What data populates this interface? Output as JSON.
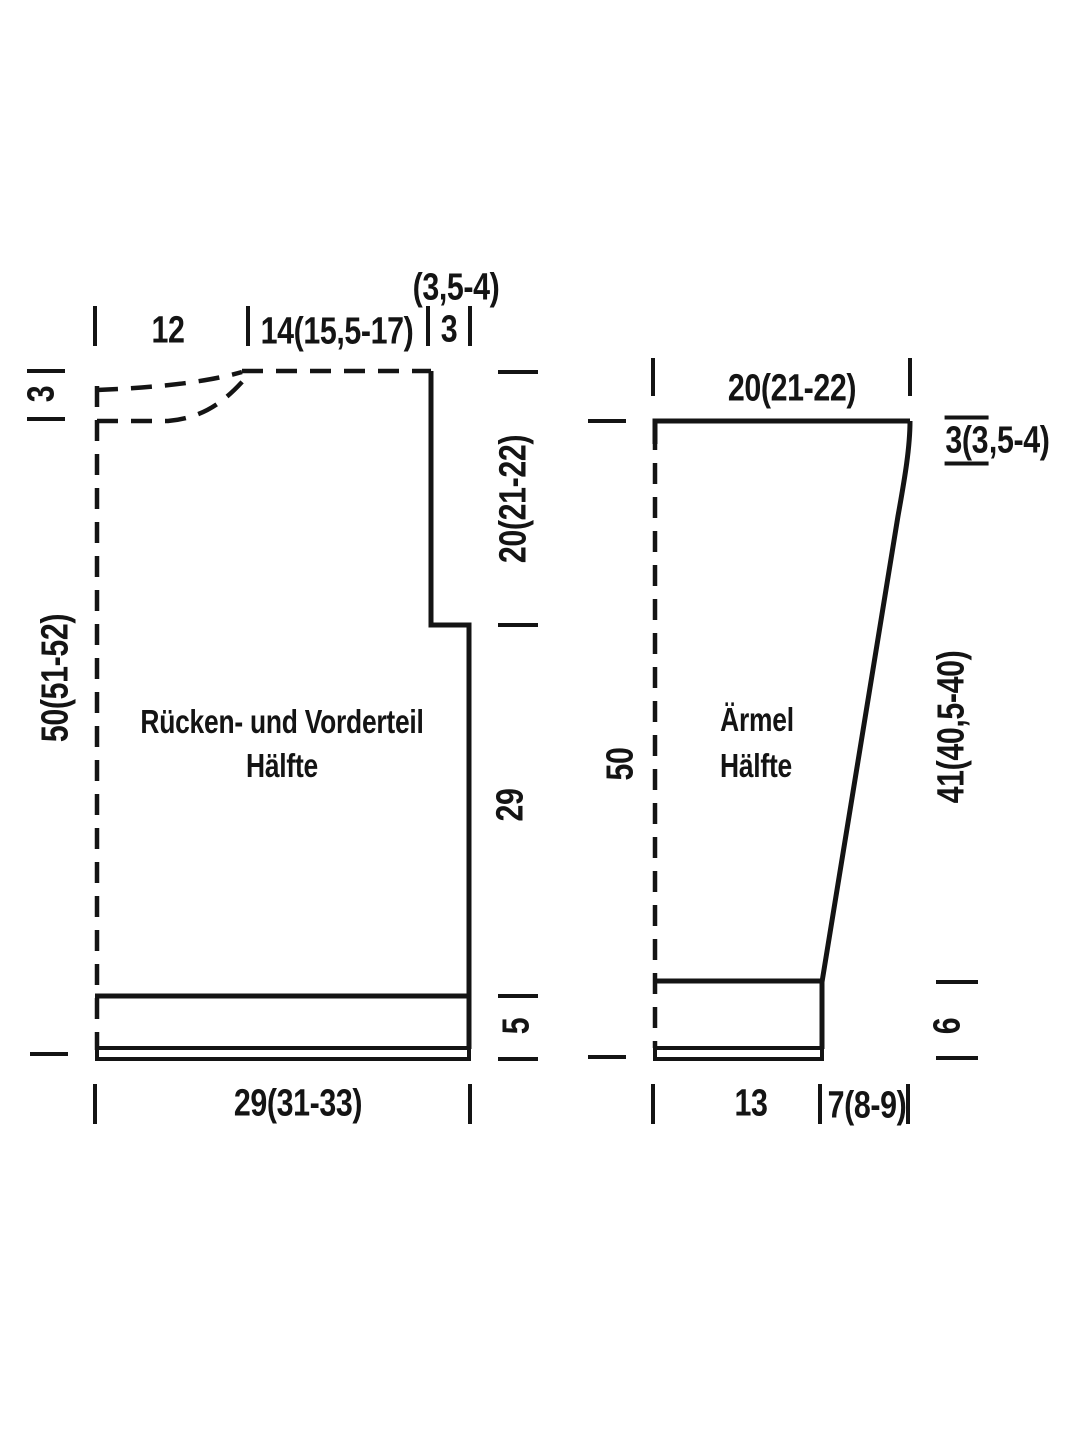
{
  "schematic": {
    "background_color": "#ffffff",
    "line_color": "#141414",
    "pieces": {
      "front_back": {
        "name_line1": "Rücken- und Vorderteil",
        "name_line2": "Hälfte",
        "measurements": {
          "neck_fold_width": "12",
          "shoulder_width": "14(15,5-17)",
          "shoulder_drop_sizes": "(3,5-4)",
          "shoulder_drop": "3",
          "neck_depth": "3",
          "total_length": "50(51-52)",
          "armhole_depth": "20(21-22)",
          "side_seam": "29",
          "hem_band": "5",
          "half_width": "29(31-33)"
        }
      },
      "sleeve": {
        "name_line1": "Ärmel",
        "name_line2": "Hälfte",
        "measurements": {
          "top_half_width": "20(21-22)",
          "cap_edge_main": "3(3",
          "cap_edge_rest": ",5-4)",
          "total_length": "50",
          "slanted_seam": "41(40,5-40)",
          "cuff_height": "6",
          "cuff_half_width": "13",
          "upper_extra_width": "7(8-9)"
        }
      }
    }
  }
}
